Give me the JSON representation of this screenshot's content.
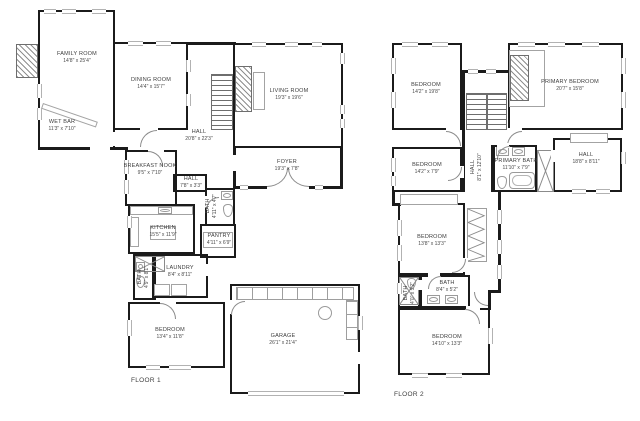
{
  "colors": {
    "wall": "#1b1b1b",
    "thin_line": "#a3a3a3",
    "label_text": "#3d3d3d",
    "background": "#ffffff"
  },
  "floor1": {
    "label": "FLOOR 1",
    "rooms": [
      {
        "name": "FAMILY ROOM",
        "dims": "14'8\" x 25'4\""
      },
      {
        "name": "WET BAR",
        "dims": "11'3\" x 7'10\""
      },
      {
        "name": "DINING ROOM",
        "dims": "14'4\" x 15'7\""
      },
      {
        "name": "LIVING ROOM",
        "dims": "19'3\" x 19'6\""
      },
      {
        "name": "HALL",
        "dims": "20'8\" x 22'3\""
      },
      {
        "name": "BREAKFAST NOOK",
        "dims": "9'5\" x 7'10\""
      },
      {
        "name": "HALL",
        "dims": "7'8\" x 3'3\""
      },
      {
        "name": "FOYER",
        "dims": "19'3\" x 7'8\""
      },
      {
        "name": "BATH",
        "dims": "4'11\" x 4'7\""
      },
      {
        "name": "KITCHEN",
        "dims": "15'5\" x 11'9\""
      },
      {
        "name": "PANTRY",
        "dims": "4'11\" x 6'9\""
      },
      {
        "name": "LAUNDRY",
        "dims": "8'4\" x 8'11\""
      },
      {
        "name": "BATH",
        "dims": "4'9\" x 8'1\""
      },
      {
        "name": "BEDROOM",
        "dims": "13'4\" x 11'8\""
      },
      {
        "name": "GARAGE",
        "dims": "26'1\" x 21'4\""
      }
    ]
  },
  "floor2": {
    "label": "FLOOR 2",
    "rooms": [
      {
        "name": "BEDROOM",
        "dims": "14'2\" x 19'8\""
      },
      {
        "name": "PRIMARY BEDROOM",
        "dims": "20'7\" x 15'8\""
      },
      {
        "name": "BEDROOM",
        "dims": "14'2\" x 7'9\""
      },
      {
        "name": "HALL",
        "dims": "8'1\" x 12'10\""
      },
      {
        "name": "PRIMARY BATH",
        "dims": "11'10\" x 7'9\""
      },
      {
        "name": "HALL",
        "dims": "18'8\" x 8'11\""
      },
      {
        "name": "BEDROOM",
        "dims": "13'8\" x 13'3\""
      },
      {
        "name": "BATH",
        "dims": "4'0\" x 5'2\""
      },
      {
        "name": "BATH",
        "dims": "8'4\" x 5'2\""
      },
      {
        "name": "BEDROOM",
        "dims": "14'10\" x 13'3\""
      }
    ]
  }
}
